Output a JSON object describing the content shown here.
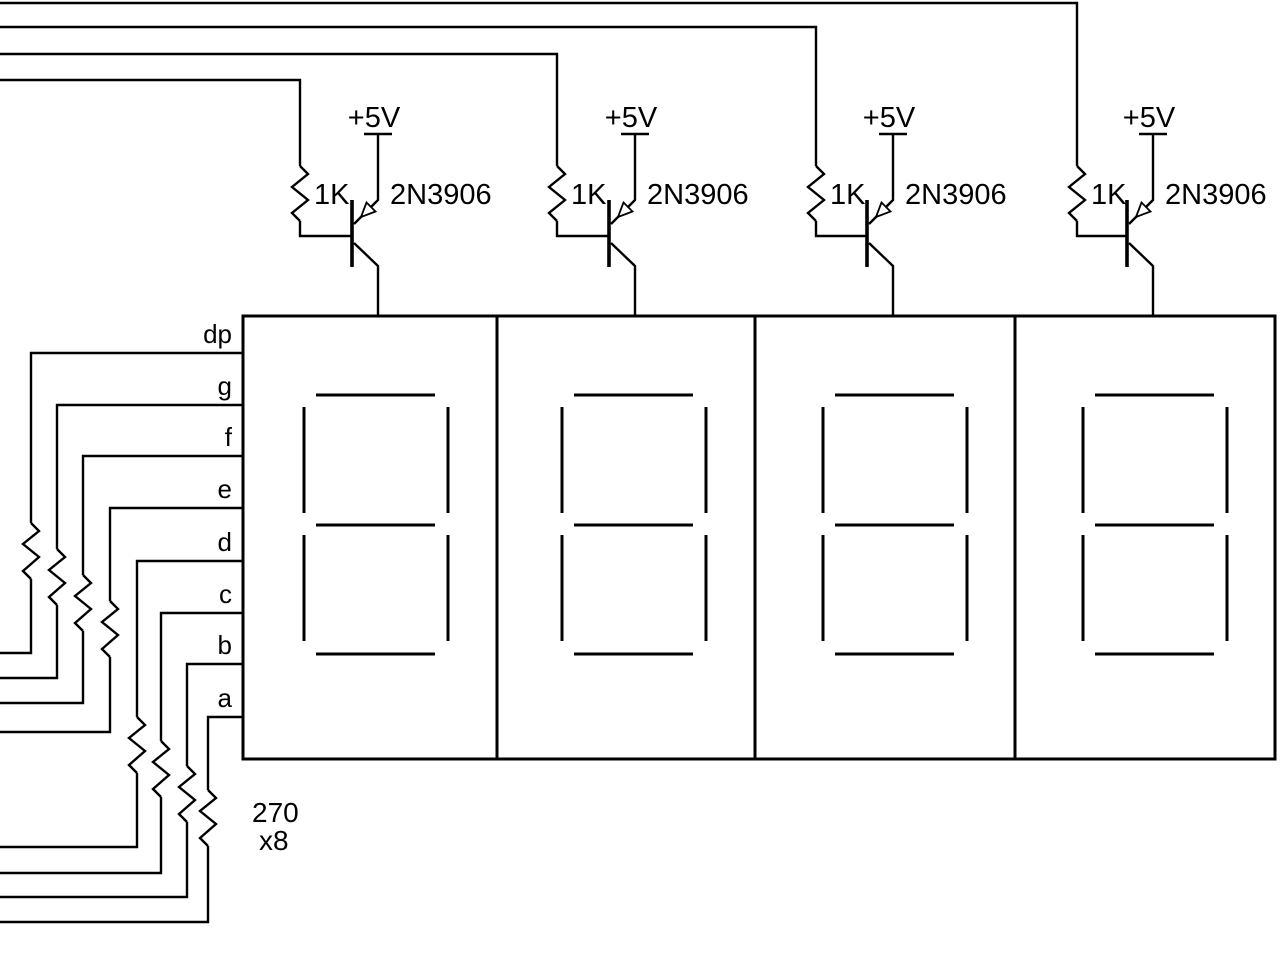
{
  "diagram": {
    "kind": "circuit-schematic",
    "description": "Four-digit seven-segment LED display driver with PNP digit-select transistors and segment current-limit resistors",
    "supply_label": "+5V",
    "stages": [
      {
        "id": 1,
        "resistor_value": "1K",
        "transistor_part": "2N3906"
      },
      {
        "id": 2,
        "resistor_value": "1K",
        "transistor_part": "2N3906"
      },
      {
        "id": 3,
        "resistor_value": "1K",
        "transistor_part": "2N3906"
      },
      {
        "id": 4,
        "resistor_value": "1K",
        "transistor_part": "2N3906"
      }
    ],
    "segment_labels": [
      "dp",
      "g",
      "f",
      "e",
      "d",
      "c",
      "b",
      "a"
    ],
    "segment_resistor": {
      "value": "270",
      "count_label": "x8"
    },
    "displays": {
      "count": 4,
      "segments_per_digit": 7
    },
    "colors": {
      "line": "#000000",
      "background": "#ffffff"
    }
  }
}
